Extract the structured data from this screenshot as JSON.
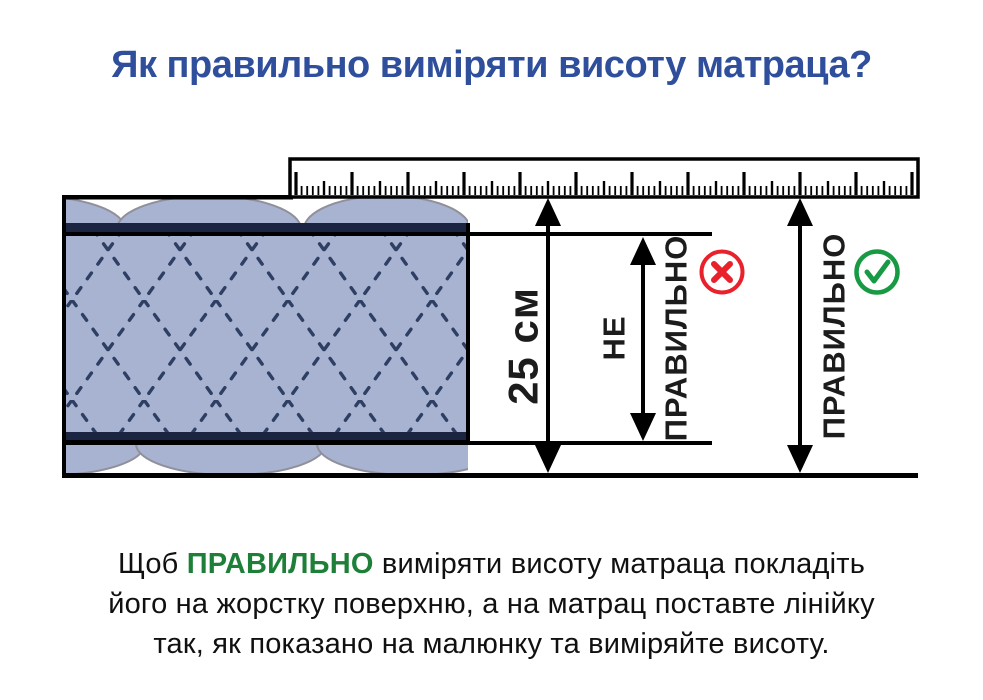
{
  "title": "Як правильно виміряти висоту матраца?",
  "diagram": {
    "height_label": "25 см",
    "wrong_label_line1": "НЕ",
    "wrong_label_line2": "ПРАВИЛЬНО",
    "correct_label": "ПРАВИЛЬНО",
    "wrong_icon": "x-circle-icon",
    "correct_icon": "check-circle-icon"
  },
  "footer": {
    "line1_prefix": "Щоб ",
    "line1_highlight": "ПРАВИЛЬНО",
    "line1_suffix": " виміряти висоту матраца покладіть",
    "line2": "його на жорстку поверхню, а на матрац поставте лінійку",
    "line3": "так, як показано на малюнку та виміряйте висоту."
  },
  "colors": {
    "title_blue": "#2f4f9c",
    "highlight_green": "#1e8038",
    "wrong_red": "#e8212b",
    "correct_green": "#189a44",
    "mattress_fill": "#a8b3d2",
    "stitch_navy": "#2e3f63",
    "band_navy": "#1b2542"
  }
}
